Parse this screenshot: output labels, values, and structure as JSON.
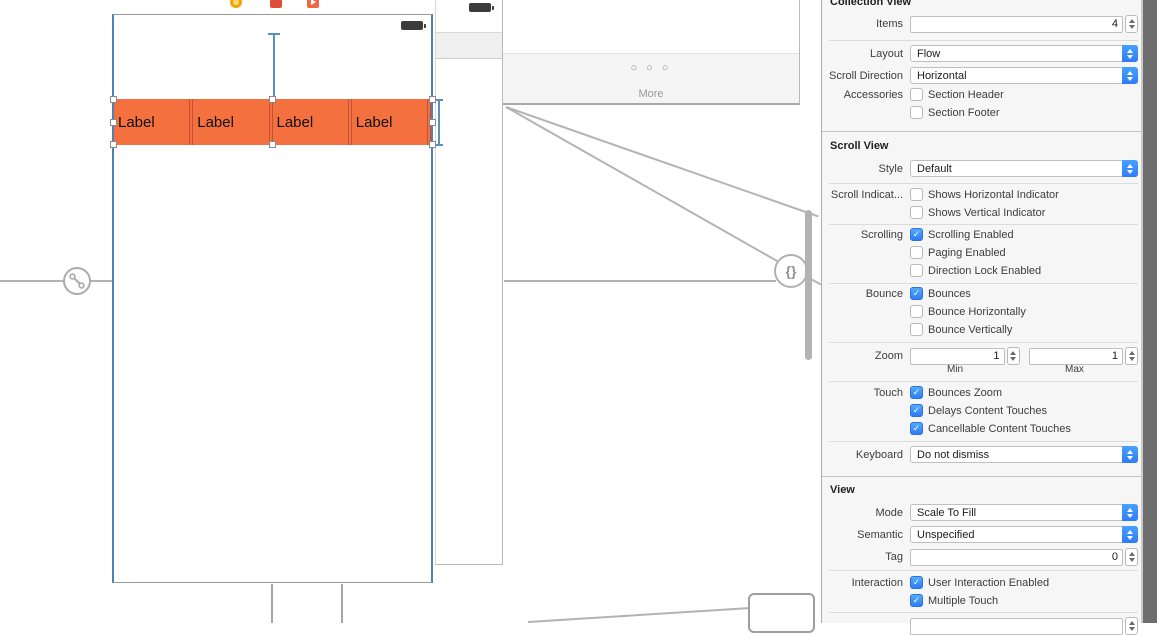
{
  "colors": {
    "cell_orange": "#f4713f",
    "cell_divider": "#c2503b",
    "selection_blue": "#4d80b3",
    "control_blue": "#2f7cf6",
    "control_blue_light": "#47a1fd",
    "checkbox_blue": "#2f7cf6",
    "checkbox_blue_light": "#55aafd"
  },
  "canvas": {
    "labels": [
      "Label",
      "Label",
      "Label",
      "Label"
    ],
    "more_dots": "○ ○ ○",
    "more_label": "More",
    "braces_badge": "{}"
  },
  "inspector": {
    "collection_view": {
      "title": "Collection View",
      "items_label": "Items",
      "items_value": "4",
      "layout_label": "Layout",
      "layout_value": "Flow",
      "scroll_direction_label": "Scroll Direction",
      "scroll_direction_value": "Horizontal",
      "accessories_label": "Accessories",
      "section_header_label": "Section Header",
      "section_header_checked": false,
      "section_footer_label": "Section Footer",
      "section_footer_checked": false
    },
    "scroll_view": {
      "title": "Scroll View",
      "style_label": "Style",
      "style_value": "Default",
      "indicators_label": "Scroll Indicat...",
      "shows_horizontal_label": "Shows Horizontal Indicator",
      "shows_horizontal_checked": false,
      "shows_vertical_label": "Shows Vertical Indicator",
      "shows_vertical_checked": false,
      "scrolling_label": "Scrolling",
      "scrolling_enabled_label": "Scrolling Enabled",
      "scrolling_enabled_checked": true,
      "paging_label": "Paging Enabled",
      "paging_checked": false,
      "direction_lock_label": "Direction Lock Enabled",
      "direction_lock_checked": false,
      "bounce_label": "Bounce",
      "bounces_label": "Bounces",
      "bounces_checked": true,
      "bounce_horizontally_label": "Bounce Horizontally",
      "bounce_horizontally_checked": false,
      "bounce_vertically_label": "Bounce Vertically",
      "bounce_vertically_checked": false,
      "zoom_label": "Zoom",
      "zoom_min_value": "1",
      "zoom_max_value": "1",
      "zoom_min_caption": "Min",
      "zoom_max_caption": "Max",
      "touch_label": "Touch",
      "bounces_zoom_label": "Bounces Zoom",
      "bounces_zoom_checked": true,
      "delays_label": "Delays Content Touches",
      "delays_checked": true,
      "cancellable_label": "Cancellable Content Touches",
      "cancellable_checked": true,
      "keyboard_label": "Keyboard",
      "keyboard_value": "Do not dismiss"
    },
    "view": {
      "title": "View",
      "mode_label": "Mode",
      "mode_value": "Scale To Fill",
      "semantic_label": "Semantic",
      "semantic_value": "Unspecified",
      "tag_label": "Tag",
      "tag_value": "0",
      "interaction_label": "Interaction",
      "user_interaction_label": "User Interaction Enabled",
      "user_interaction_checked": true,
      "multiple_touch_label": "Multiple Touch",
      "multiple_touch_checked": true
    }
  }
}
